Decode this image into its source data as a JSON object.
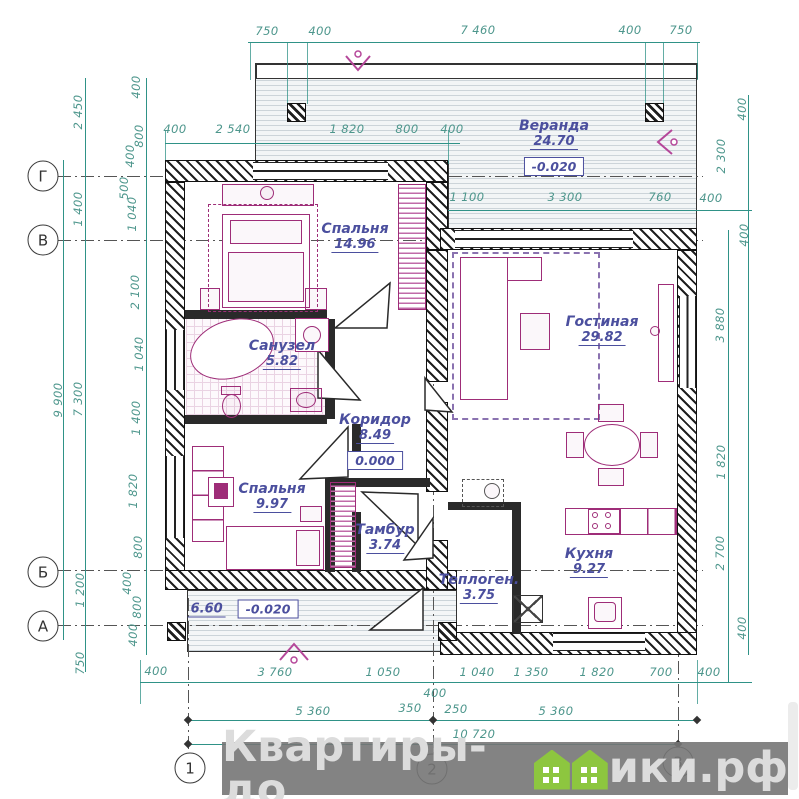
{
  "colors": {
    "dimension": "#2f9287",
    "label": "#4b4f9e",
    "furniture": "#9e2d78",
    "walls": "#1f1f1f",
    "watermark_green": "#8dc63f"
  },
  "watermark": {
    "prefix": "Квартиры-до",
    "suffix": "ики.рф"
  },
  "axes": {
    "rows": [
      {
        "label": "Г",
        "y": 176
      },
      {
        "label": "В",
        "y": 240
      },
      {
        "label": "Б",
        "y": 572
      },
      {
        "label": "А",
        "y": 626
      }
    ],
    "cols": [
      {
        "label": "1",
        "x": 190,
        "y": 768
      },
      {
        "label": "2",
        "x": 432,
        "y": 769
      },
      {
        "label": "3",
        "x": 678,
        "y": 762
      }
    ]
  },
  "rooms": [
    {
      "name": "Веранда",
      "area": "24.70",
      "level": "-0.020",
      "x": 554,
      "y": 128
    },
    {
      "name": "Спальня",
      "area": "14.96",
      "x": 355,
      "y": 231
    },
    {
      "name": "Гостиная",
      "area": "29.82",
      "x": 602,
      "y": 324
    },
    {
      "name": "Санузел",
      "area": "5.82",
      "x": 282,
      "y": 348
    },
    {
      "name": "Коридор",
      "area": "8.49",
      "level": "0.000",
      "x": 375,
      "y": 422
    },
    {
      "name": "Спальня",
      "area": "9.97",
      "x": 272,
      "y": 491
    },
    {
      "name": "Тамбур",
      "area": "3.74",
      "x": 385,
      "y": 532
    },
    {
      "name": "Теплоген.",
      "area": "3.75",
      "x": 479,
      "y": 582
    },
    {
      "name": "Кухня",
      "area": "9.27",
      "x": 589,
      "y": 556
    },
    {
      "name": "",
      "area": "6.60",
      "level": "-0.020",
      "x": 243,
      "y": 609,
      "inline": true
    }
  ],
  "dims": [
    {
      "t": "750",
      "x": 267,
      "y": 31
    },
    {
      "t": "400",
      "x": 320,
      "y": 31
    },
    {
      "t": "7 460",
      "x": 478,
      "y": 30
    },
    {
      "t": "400",
      "x": 630,
      "y": 30
    },
    {
      "t": "750",
      "x": 681,
      "y": 30
    },
    {
      "t": "400",
      "x": 175,
      "y": 129
    },
    {
      "t": "2 540",
      "x": 233,
      "y": 129
    },
    {
      "t": "1 820",
      "x": 347,
      "y": 129
    },
    {
      "t": "800",
      "x": 407,
      "y": 129
    },
    {
      "t": "400",
      "x": 452,
      "y": 129
    },
    {
      "t": "1 100",
      "x": 467,
      "y": 197
    },
    {
      "t": "3 300",
      "x": 565,
      "y": 197
    },
    {
      "t": "760",
      "x": 660,
      "y": 197
    },
    {
      "t": "400",
      "x": 711,
      "y": 198
    },
    {
      "t": "400",
      "x": 156,
      "y": 671
    },
    {
      "t": "3 760",
      "x": 275,
      "y": 672
    },
    {
      "t": "1 050",
      "x": 383,
      "y": 672
    },
    {
      "t": "1 040",
      "x": 477,
      "y": 672
    },
    {
      "t": "1 350",
      "x": 531,
      "y": 672
    },
    {
      "t": "1 820",
      "x": 597,
      "y": 672
    },
    {
      "t": "700",
      "x": 661,
      "y": 672
    },
    {
      "t": "400",
      "x": 709,
      "y": 672
    },
    {
      "t": "400",
      "x": 435,
      "y": 693
    },
    {
      "t": "350",
      "x": 410,
      "y": 708
    },
    {
      "t": "250",
      "x": 456,
      "y": 709
    },
    {
      "t": "5 360",
      "x": 313,
      "y": 711
    },
    {
      "t": "5 360",
      "x": 556,
      "y": 711
    },
    {
      "t": "10 720",
      "x": 474,
      "y": 734
    },
    {
      "t": "2 450",
      "x": 78,
      "y": 112,
      "r": -90
    },
    {
      "t": "1 400",
      "x": 78,
      "y": 209,
      "r": -90
    },
    {
      "t": "9 900",
      "x": 58,
      "y": 400,
      "r": -90
    },
    {
      "t": "7 300",
      "x": 78,
      "y": 399,
      "r": -90
    },
    {
      "t": "1 200",
      "x": 80,
      "y": 590,
      "r": -90
    },
    {
      "t": "750",
      "x": 80,
      "y": 663,
      "r": -90
    },
    {
      "t": "400",
      "x": 136,
      "y": 87,
      "r": -90
    },
    {
      "t": "800",
      "x": 139,
      "y": 136,
      "r": -90
    },
    {
      "t": "400",
      "x": 130,
      "y": 156,
      "r": -90
    },
    {
      "t": "500",
      "x": 124,
      "y": 188,
      "r": -90
    },
    {
      "t": "1 040",
      "x": 132,
      "y": 214,
      "r": -90
    },
    {
      "t": "2 100",
      "x": 135,
      "y": 292,
      "r": -90
    },
    {
      "t": "1 040",
      "x": 139,
      "y": 354,
      "r": -90
    },
    {
      "t": "1 400",
      "x": 136,
      "y": 418,
      "r": -90
    },
    {
      "t": "1 820",
      "x": 133,
      "y": 491,
      "r": -90
    },
    {
      "t": "800",
      "x": 138,
      "y": 547,
      "r": -90
    },
    {
      "t": "400",
      "x": 127,
      "y": 583,
      "r": -90
    },
    {
      "t": "800",
      "x": 137,
      "y": 607,
      "r": -90
    },
    {
      "t": "400",
      "x": 133,
      "y": 635,
      "r": -90
    },
    {
      "t": "400",
      "x": 742,
      "y": 109,
      "r": -90
    },
    {
      "t": "2 300",
      "x": 721,
      "y": 156,
      "r": -90
    },
    {
      "t": "400",
      "x": 744,
      "y": 235,
      "r": -90
    },
    {
      "t": "3 880",
      "x": 720,
      "y": 325,
      "r": -90
    },
    {
      "t": "1 820",
      "x": 721,
      "y": 462,
      "r": -90
    },
    {
      "t": "2 700",
      "x": 720,
      "y": 553,
      "r": -90
    },
    {
      "t": "400",
      "x": 742,
      "y": 628,
      "r": -90
    }
  ]
}
